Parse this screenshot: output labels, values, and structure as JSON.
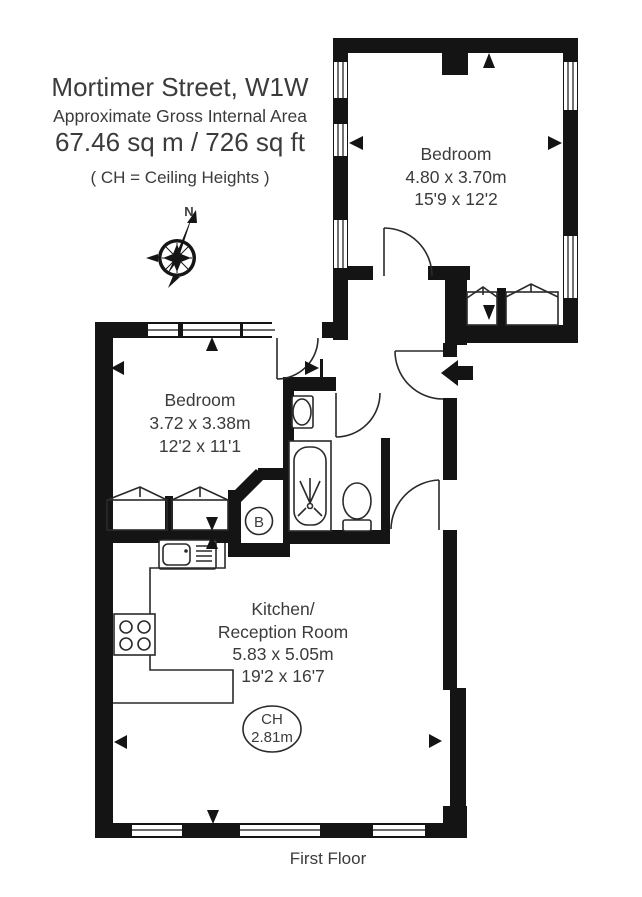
{
  "header": {
    "title": "Mortimer Street, W1W",
    "subtitle": "Approximate Gross Internal Area",
    "area": "67.46 sq m  /  726 sq ft",
    "note": "( CH = Ceiling Heights )"
  },
  "compass": {
    "north_label": "N"
  },
  "rooms": {
    "bedroom1": {
      "name": "Bedroom",
      "size_m": "4.80 x 3.70m",
      "size_ft": "15'9 x 12'2"
    },
    "bedroom2": {
      "name": "Bedroom",
      "size_m": "3.72 x 3.38m",
      "size_ft": "12'2 x 11'1"
    },
    "kitchen": {
      "name_line1": "Kitchen/",
      "name_line2": "Reception Room",
      "size_m": "5.83 x 5.05m",
      "size_ft": "19'2 x 16'7"
    }
  },
  "ceiling_height": {
    "label": "CH",
    "value": "2.81m"
  },
  "boiler": {
    "label": "B"
  },
  "footer": {
    "label": "First Floor"
  },
  "icons": {
    "compass": "compass-rose",
    "entrance": "entrance-arrow",
    "fixtures": [
      "bathtub",
      "toilet",
      "basin",
      "kitchen-sink",
      "hob"
    ]
  },
  "colors": {
    "walls": "#141414",
    "text": "#3b3b3b",
    "background": "#ffffff"
  }
}
